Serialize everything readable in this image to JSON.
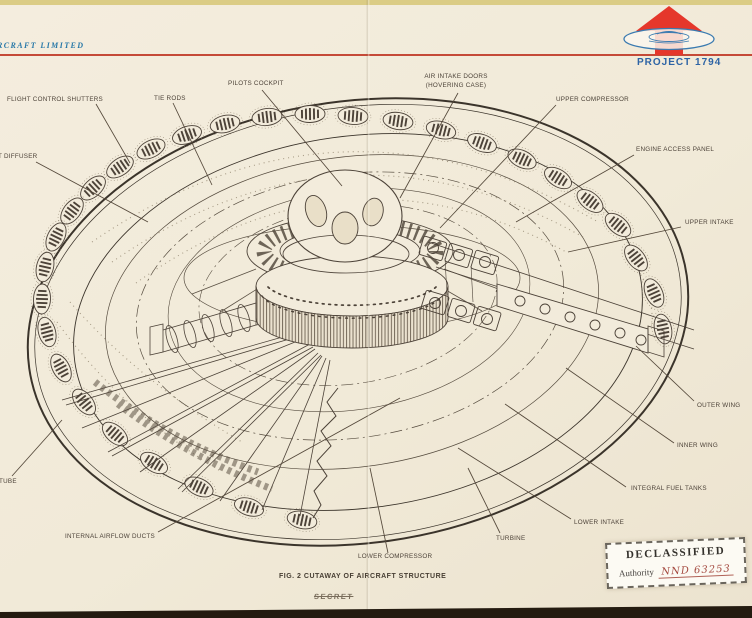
{
  "header": {
    "company": "RCRAFT LIMITED",
    "project": "PROJECT 1794",
    "logo": "red-arrow-with-blue-saucer"
  },
  "callouts": [
    {
      "id": "flight-control-shutters",
      "text": "FLIGHT CONTROL SHUTTERS"
    },
    {
      "id": "tie-rods",
      "text": "TIE RODS"
    },
    {
      "id": "pilots-cockpit",
      "text": "PILOTS COCKPIT"
    },
    {
      "id": "air-intake-doors",
      "text": "AIR INTAKE DOORS\n(HOVERING CASE)"
    },
    {
      "id": "upper-compressor",
      "text": "UPPER COMPRESSOR"
    },
    {
      "id": "engine-access-panel",
      "text": "ENGINE ACCESS PANEL"
    },
    {
      "id": "upper-intake",
      "text": "UPPER INTAKE"
    },
    {
      "id": "outer-wing",
      "text": "OUTER WING"
    },
    {
      "id": "inner-wing",
      "text": "INNER WING"
    },
    {
      "id": "integral-fuel-tanks",
      "text": "INTEGRAL FUEL TANKS"
    },
    {
      "id": "lower-intake",
      "text": "LOWER INTAKE"
    },
    {
      "id": "turbine",
      "text": "TURBINE"
    },
    {
      "id": "lower-compressor",
      "text": "LOWER COMPRESSOR"
    },
    {
      "id": "internal-airflow-ducts",
      "text": "INTERNAL AIRFLOW DUCTS"
    },
    {
      "id": "diffuser-partial",
      "text": "T DIFFUSER"
    },
    {
      "id": "tube-partial",
      "text": "TUBE"
    }
  ],
  "figure": {
    "caption": "FIG. 2 CUTAWAY OF AIRCRAFT STRUCTURE",
    "struck_stamp": "SECRET"
  },
  "declassified": {
    "title": "DECLASSIFIED",
    "authority_label": "Authority",
    "authority_number": "NND 63253"
  },
  "colors": {
    "paper": "#f1ead8",
    "ink": "#4c4238",
    "rule_red": "#c54a38",
    "logo_red": "#e5372b",
    "logo_blue": "#3a7ab0",
    "project_blue": "#2e64a5",
    "stamp_number_red": "#a4493f"
  }
}
